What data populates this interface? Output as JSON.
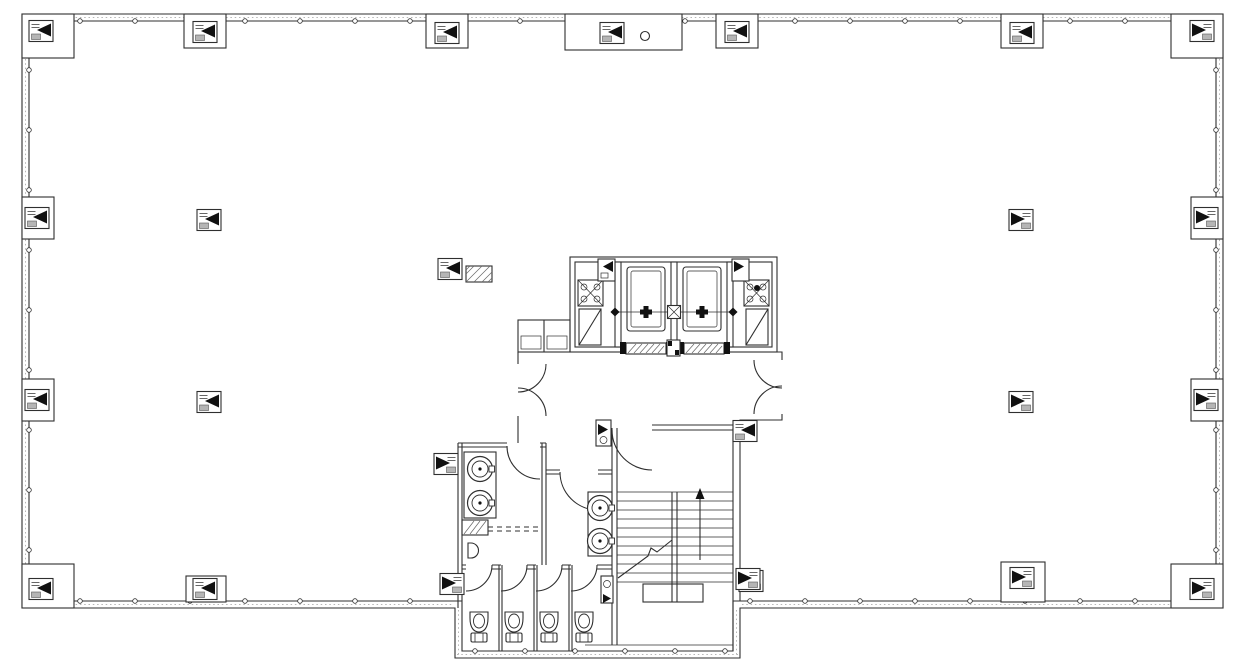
{
  "document": {
    "kind": "architectural-floor-plan",
    "visible_text": ""
  },
  "colors": {
    "background": "#ffffff",
    "line": "#2f2f2f",
    "line_light": "#b6b6b6",
    "fill_black": "#111111",
    "hatch_gray": "#b5b5b5"
  },
  "plan": {
    "counts": {
      "elevators": 2,
      "service_shafts": 2,
      "stairs": 1,
      "toilet_stalls": 4,
      "toilets": 4,
      "wash_basins": 4,
      "urinals": 1,
      "lobby_double_doors": 2
    },
    "column_tags": [
      {
        "x": 41,
        "y": 31,
        "dir": "left"
      },
      {
        "x": 1202,
        "y": 31,
        "dir": "right"
      },
      {
        "x": 41,
        "y": 589,
        "dir": "left"
      },
      {
        "x": 1202,
        "y": 589,
        "dir": "right"
      },
      {
        "x": 205,
        "y": 32,
        "dir": "left"
      },
      {
        "x": 447,
        "y": 33,
        "dir": "left"
      },
      {
        "x": 612,
        "y": 33,
        "dir": "left"
      },
      {
        "x": 737,
        "y": 32,
        "dir": "left"
      },
      {
        "x": 1022,
        "y": 33,
        "dir": "left"
      },
      {
        "x": 205,
        "y": 589,
        "dir": "left"
      },
      {
        "x": 1022,
        "y": 578,
        "dir": "right"
      },
      {
        "x": 452,
        "y": 584,
        "dir": "right"
      },
      {
        "x": 751,
        "y": 581,
        "dir": "right"
      },
      {
        "x": 37,
        "y": 218,
        "dir": "left"
      },
      {
        "x": 37,
        "y": 400,
        "dir": "left"
      },
      {
        "x": 1206,
        "y": 218,
        "dir": "right"
      },
      {
        "x": 1206,
        "y": 400,
        "dir": "right"
      },
      {
        "x": 209,
        "y": 220,
        "dir": "left"
      },
      {
        "x": 209,
        "y": 402,
        "dir": "left"
      },
      {
        "x": 1021,
        "y": 220,
        "dir": "right"
      },
      {
        "x": 1021,
        "y": 402,
        "dir": "right"
      },
      {
        "x": 450,
        "y": 269,
        "dir": "left"
      },
      {
        "x": 446,
        "y": 464,
        "dir": "right"
      },
      {
        "x": 745,
        "y": 431,
        "dir": "left"
      },
      {
        "x": 748,
        "y": 579,
        "dir": "right"
      }
    ],
    "toilets": [
      {
        "x": 479,
        "y": 612
      },
      {
        "x": 514,
        "y": 612
      },
      {
        "x": 549,
        "y": 612
      },
      {
        "x": 584,
        "y": 612
      }
    ],
    "sinks": [
      {
        "x": 480,
        "y": 469
      },
      {
        "x": 480,
        "y": 503
      },
      {
        "x": 600,
        "y": 508
      },
      {
        "x": 600,
        "y": 541
      }
    ],
    "elevator_centers": [
      {
        "x": 646,
        "y": 312
      },
      {
        "x": 702,
        "y": 312
      }
    ],
    "mullion_runs": [
      {
        "axis": "h",
        "y": 21,
        "from": 80,
        "to": 1165,
        "step": 55
      },
      {
        "axis": "h",
        "y": 601,
        "from": 80,
        "to": 440,
        "step": 55
      },
      {
        "axis": "h",
        "y": 601,
        "from": 750,
        "to": 1165,
        "step": 55
      },
      {
        "axis": "h",
        "y": 651,
        "from": 475,
        "to": 725,
        "step": 50
      },
      {
        "axis": "v",
        "x": 29,
        "from": 70,
        "to": 556,
        "step": 60
      },
      {
        "axis": "v",
        "x": 1216,
        "from": 70,
        "to": 556,
        "step": 60
      }
    ]
  }
}
